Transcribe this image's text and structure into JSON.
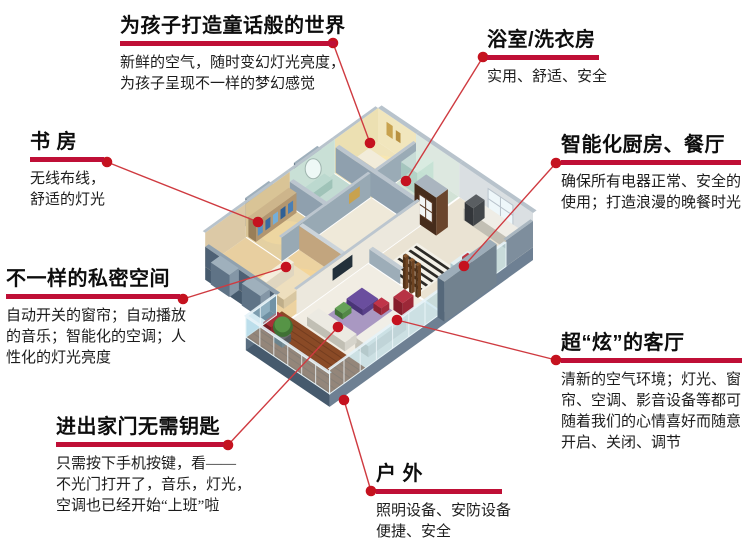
{
  "page": {
    "background": "#ffffff"
  },
  "accent": {
    "rule_color": "#bf0f36",
    "line_color": "#cf3a40",
    "dot_color": "#c5121f"
  },
  "callouts": [
    {
      "id": "children-room",
      "title": "为孩子打造童话般的世界",
      "lines": [
        "新鲜的空气，随时变幻灯光亮度，",
        "为孩子呈现不一样的梦幻感觉"
      ]
    },
    {
      "id": "bathroom-laundry",
      "title": "浴室/洗衣房",
      "lines": [
        "实用、舒适、安全"
      ]
    },
    {
      "id": "study-room",
      "title": "书 房",
      "lines": [
        "无线布线，",
        "舒适的灯光"
      ]
    },
    {
      "id": "smart-kitchen-dining",
      "title": "智能化厨房、餐厅",
      "lines": [
        "确保所有电器正常、安全的",
        "使用；打造浪漫的晚餐时光"
      ]
    },
    {
      "id": "private-space",
      "title": "不一样的私密空间",
      "lines": [
        "自动开关的窗帘；自动播放",
        "的音乐；智能化的空调；人",
        "性化的灯光亮度"
      ]
    },
    {
      "id": "cool-living-room",
      "title": "超“炫”的客厅",
      "lines": [
        "清新的空气环境；灯光、窗",
        "帘、空调、影音设备等都可",
        "随着我们的心情喜好而随意",
        "开启、关闭、调节"
      ]
    },
    {
      "id": "keyless-entry",
      "title": "进出家门无需钥匙",
      "lines": [
        "只需按下手机按键，看——",
        "不光门打开了，音乐，灯光，",
        "空调也已经开始“上班”啦"
      ]
    },
    {
      "id": "outdoor",
      "title": "户 外",
      "lines": [
        "照明设备、安防设备",
        "便捷、安全"
      ]
    }
  ]
}
